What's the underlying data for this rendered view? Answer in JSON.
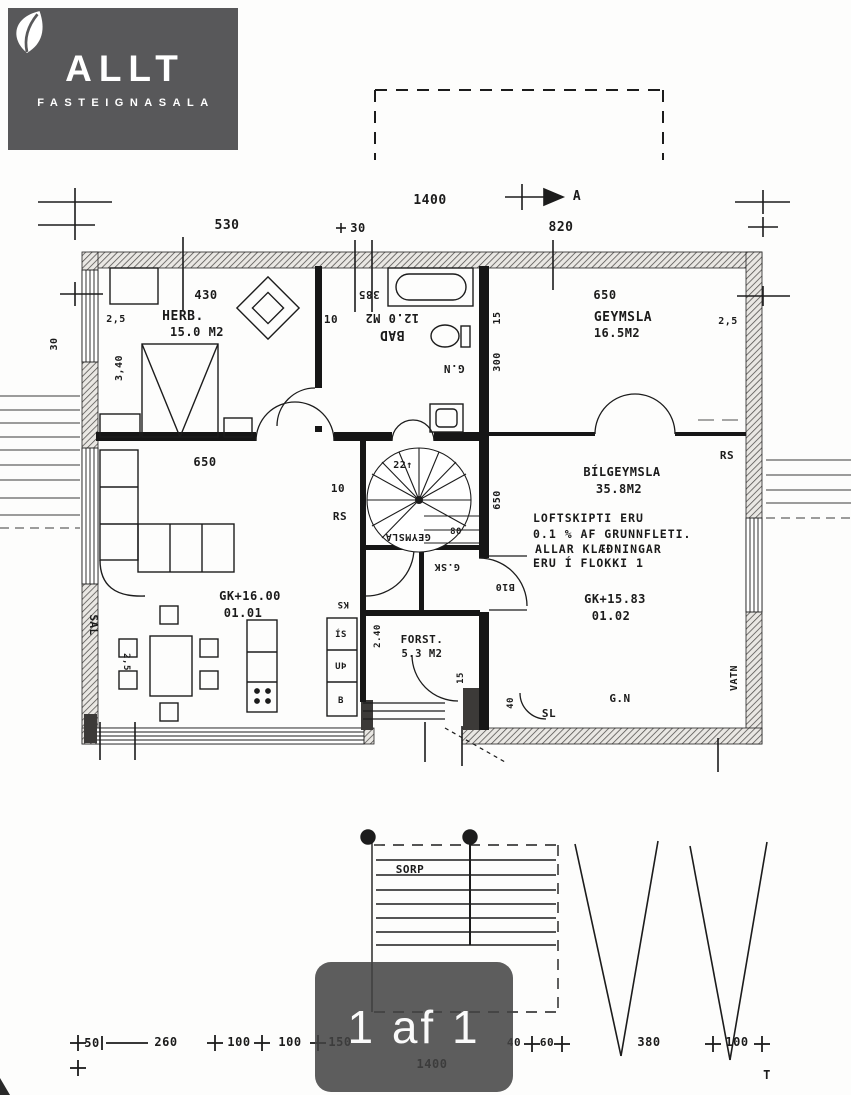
{
  "logo": {
    "brand": "ALLT",
    "tagline": "FASTEIGNASALA"
  },
  "pager": {
    "label": "1 af 1"
  },
  "plan": {
    "rooms": {
      "herb": {
        "name": "HERB.",
        "area": "15.0 M2"
      },
      "bad": {
        "name": "BAD",
        "area": "12.0 M2"
      },
      "geymsla": {
        "name": "GEYMSLA",
        "area": "16.5M2"
      },
      "bilgeymsla": {
        "name": "BÍLGEYMSLA",
        "area": "35.8M2"
      },
      "forst": {
        "name": "FORST.",
        "area": "5.3 M2"
      },
      "geymsla_inner": {
        "name": "GEYMSLA"
      },
      "gsk": {
        "name": "G.SK"
      },
      "sal": {
        "name": "SAL"
      },
      "sorp": {
        "name": "SORP"
      }
    },
    "levels": {
      "living": "GK+16.00",
      "living_id": "01.01",
      "garage": "GK+15.83",
      "garage_id": "01.02"
    },
    "notes": {
      "line1": "LOFTSKIPTI ERU",
      "line2": "0.1 % AF GRUNNFLETI.",
      "line3": "ALLAR KLÆÐNINGAR",
      "line4": "ERU Í FLOKKI 1"
    },
    "compass": "A",
    "stair_label": "22↑",
    "annotations": {
      "gn_bath": "G.N",
      "gn_garage": "G.N",
      "rs_right": "RS",
      "rs_stair": "RS",
      "sl": "SL",
      "vatn": "VATN",
      "b10": "B10",
      "ks": "KS",
      "is": "ÍS",
      "up": "UÞ",
      "b": "B"
    },
    "dims": {
      "top_530": "530",
      "top_30": "30",
      "top_1400": "1400",
      "top_820": "820",
      "herb_430": "430",
      "herb_25": "2,5",
      "herb_340": "3,40",
      "left_30": "30",
      "mid_10": "10",
      "bad_385": "385",
      "bad_15": "15",
      "bad_300": "300",
      "geym_650": "650",
      "geym_25": "2,5",
      "liv_650": "650",
      "stair_10": "10",
      "stair_80": "80",
      "gar_650": "650",
      "sal_25": "2,5",
      "forst_240": "2.40",
      "forst_15": "15",
      "gar_40": "40",
      "bot_50": "50",
      "bot_260": "260",
      "bot_100a": "100",
      "bot_100b": "100",
      "bot_150": "150",
      "bot_1400": "1400",
      "bot_40": "40",
      "bot_60": "60",
      "bot_380": "380",
      "bot_100c": "100",
      "bot_T": "T"
    }
  }
}
